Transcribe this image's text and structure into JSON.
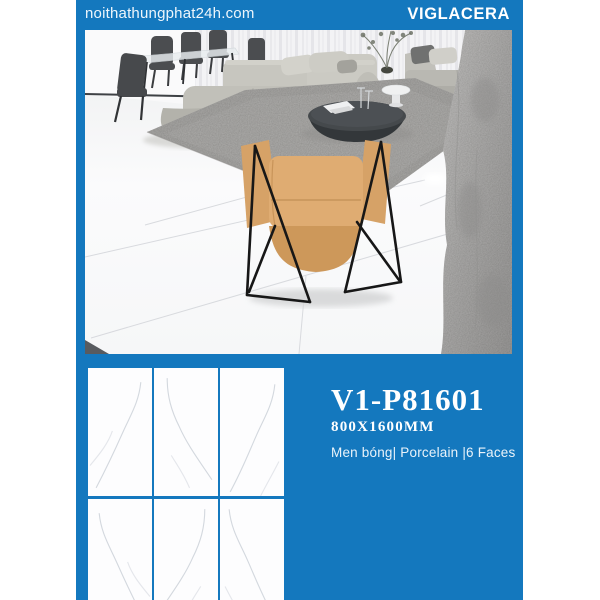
{
  "header": {
    "site": "noithathungphat24h.com",
    "brand": "VIGLACERA"
  },
  "product": {
    "code": "V1-P81601",
    "size": "800X1600MM",
    "specs": "Men bóng| Porcelain |6 Faces"
  },
  "colors": {
    "accent_blue": "#1478BE",
    "tile_white": "#fdfdfe",
    "vein_grey": "#c6ccd4"
  },
  "tile_grid": {
    "rows": 2,
    "cols": 3
  },
  "photo": {
    "subject": "living room with white marble porcelain tile floor, grey sectional sofa, tan sling chair, round dark coffee table, dining set, grey stone pillar"
  }
}
